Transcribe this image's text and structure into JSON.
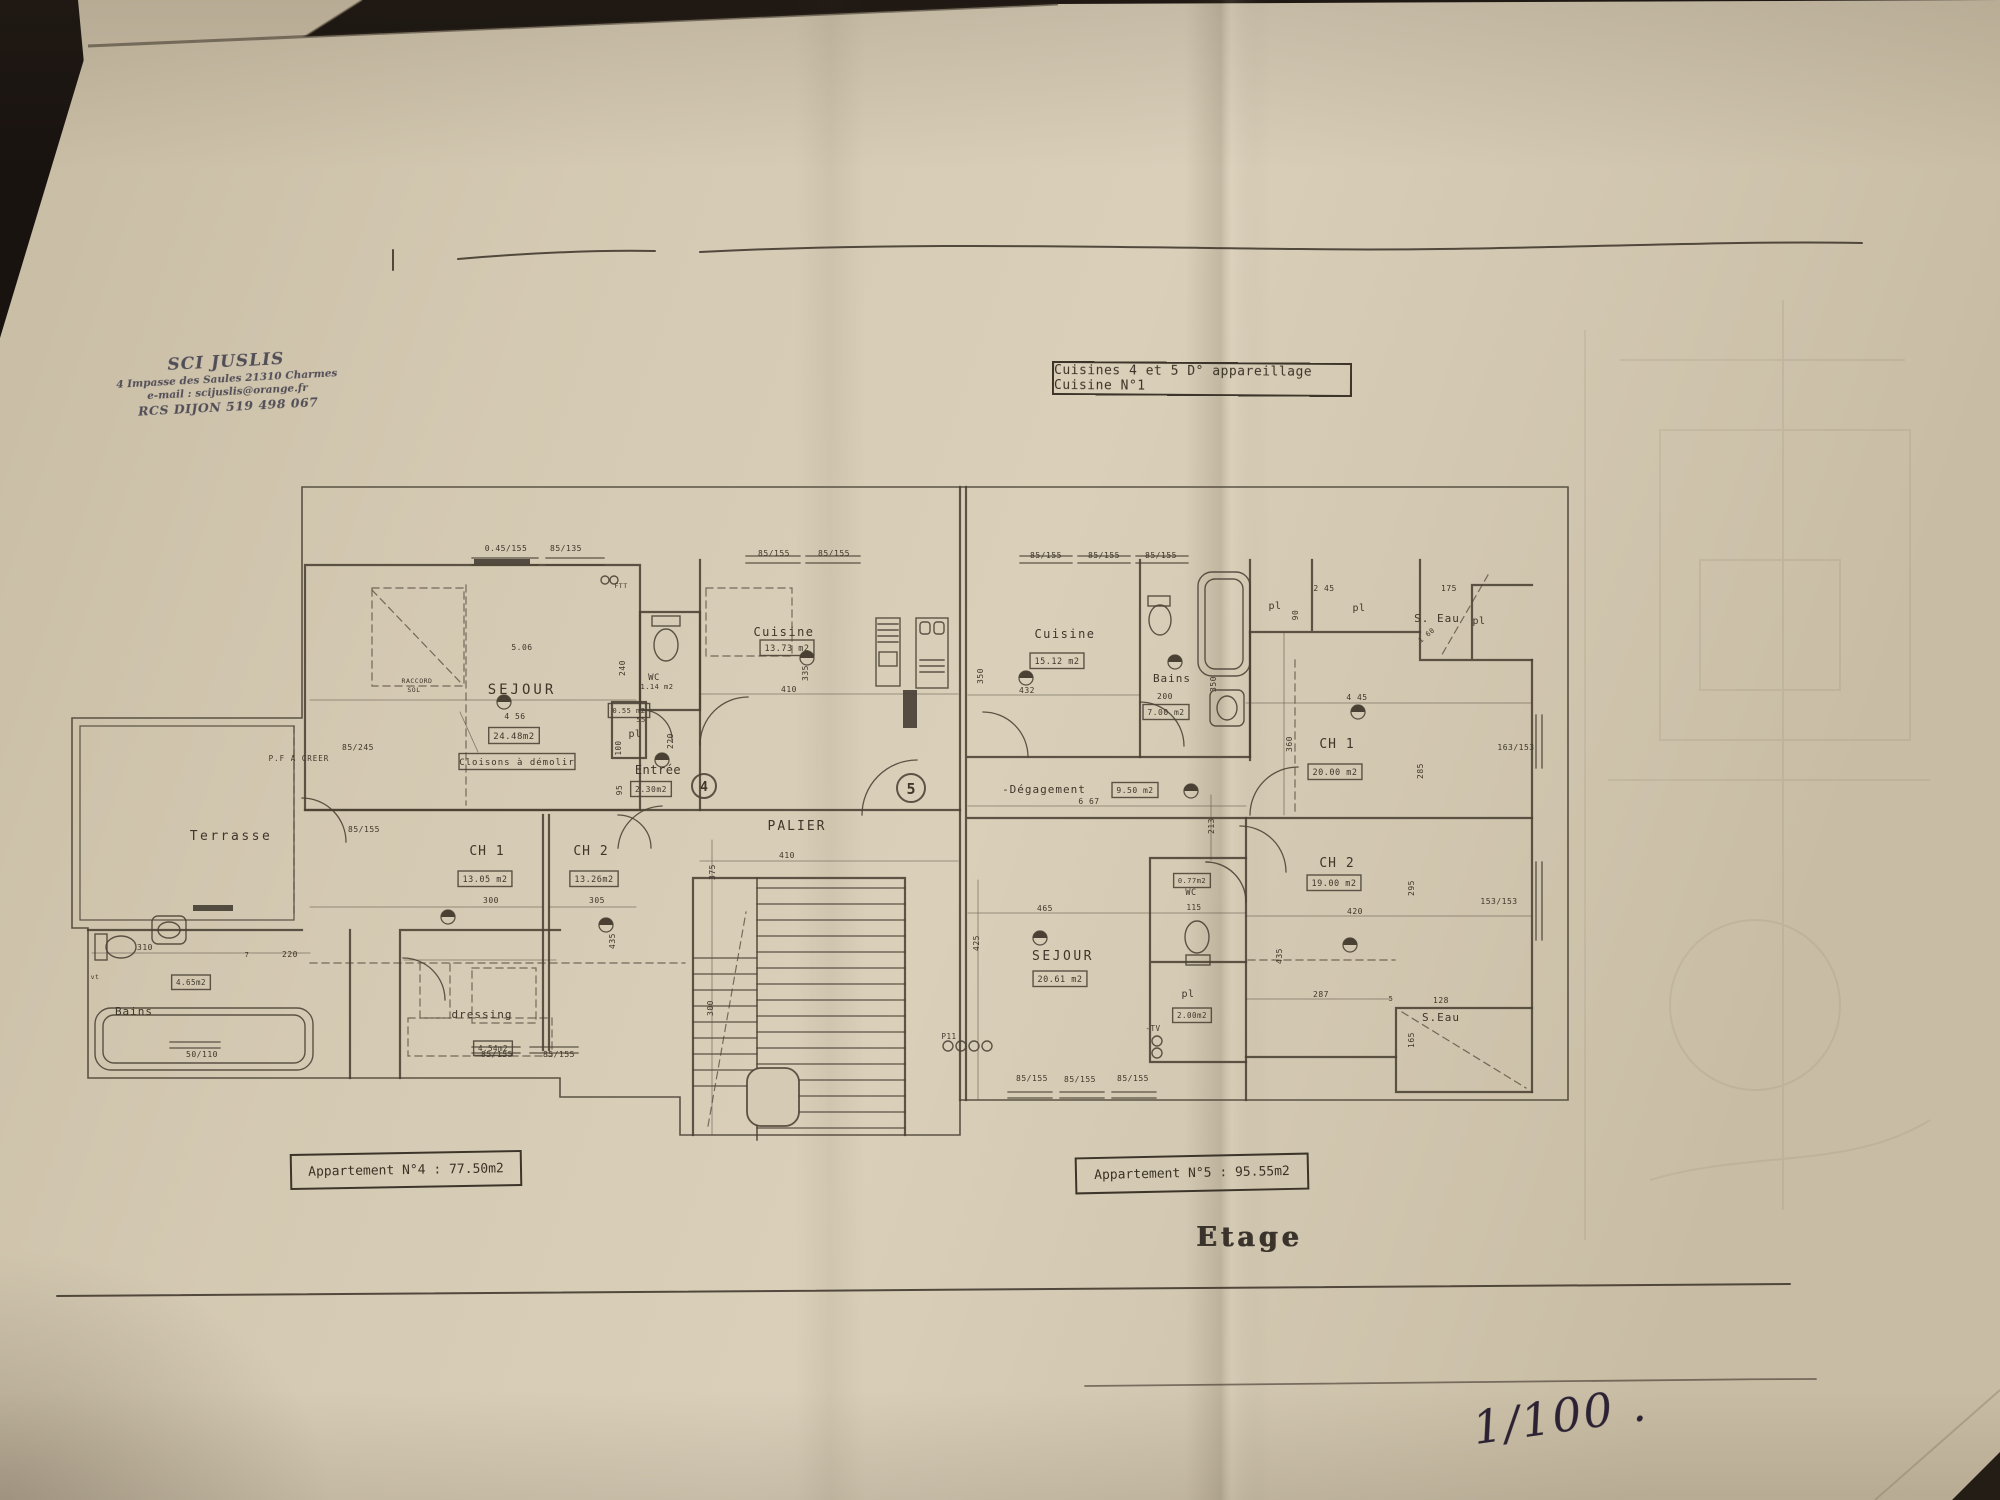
{
  "photo": {
    "background_color": "#191310",
    "paper_color": "#d5c9b2",
    "ink_color": "#4a4134",
    "stamp_ink": "#43414e",
    "handwriting_ink": "#2c2233"
  },
  "stamp": {
    "company": "SCI JUSLIS",
    "address": "4 Impasse des Saules 21310 Charmes",
    "email": "e-mail : scijuslis@orange.fr",
    "rcs": "RCS DIJON 519 498 067"
  },
  "title_box": {
    "text": "Cuisines 4 et 5  D° appareillage  Cuisine N°1"
  },
  "apartment_labels": {
    "apt4": "Appartement N°4  : 77.50m2",
    "apt5": "Appartement N°5 : 95.55m2"
  },
  "floor_label": "Etage",
  "scale_note": "1/100 .",
  "plan": {
    "circled_units": [
      "4",
      "5"
    ],
    "symbols": [
      [
        504,
        702
      ],
      [
        448,
        917
      ],
      [
        606,
        925
      ],
      [
        662,
        760
      ],
      [
        807,
        658
      ],
      [
        1026,
        678
      ],
      [
        1191,
        791
      ],
      [
        1175,
        662
      ],
      [
        1358,
        712
      ],
      [
        1350,
        945
      ],
      [
        1040,
        938
      ]
    ],
    "labels": [
      {
        "t": "Terrasse",
        "x": 231,
        "y": 840,
        "s": 13,
        "ls": 2.5
      },
      {
        "t": "P.F A CREER",
        "x": 299,
        "y": 761,
        "s": 7.5,
        "ls": 1
      },
      {
        "t": "SEJOUR",
        "x": 522,
        "y": 694,
        "s": 14,
        "ls": 3
      },
      {
        "t": "4 56",
        "x": 515,
        "y": 719,
        "s": 8
      },
      {
        "t": "5.06",
        "x": 522,
        "y": 650,
        "s": 8
      },
      {
        "t": "24.48m2",
        "x": 514,
        "y": 739,
        "b": 1,
        "s": 9
      },
      {
        "t": "Cloisons à démolir",
        "x": 517,
        "y": 765,
        "b": 1,
        "s": 9,
        "ls": 1
      },
      {
        "t": "RACCORD",
        "x": 417,
        "y": 683,
        "s": 6.5
      },
      {
        "t": "SOL",
        "x": 414,
        "y": 692,
        "s": 6.5
      },
      {
        "t": "CH 1",
        "x": 487,
        "y": 855,
        "s": 13,
        "ls": 1
      },
      {
        "t": "13.05 m2",
        "x": 485,
        "y": 882,
        "b": 1,
        "s": 8.5
      },
      {
        "t": "300",
        "x": 491,
        "y": 903,
        "s": 8
      },
      {
        "t": "CH 2",
        "x": 591,
        "y": 855,
        "s": 13,
        "ls": 1
      },
      {
        "t": "13.26m2",
        "x": 594,
        "y": 882,
        "b": 1,
        "s": 8.5
      },
      {
        "t": "305",
        "x": 597,
        "y": 903,
        "s": 8
      },
      {
        "t": "Bains",
        "x": 134,
        "y": 1015,
        "s": 11,
        "ls": 1
      },
      {
        "t": "4.65m2",
        "x": 191,
        "y": 985,
        "b": 1,
        "s": 7.5
      },
      {
        "t": "310",
        "x": 145,
        "y": 950,
        "s": 8
      },
      {
        "t": "vt",
        "x": 95,
        "y": 979,
        "s": 6.5
      },
      {
        "t": "dressing",
        "x": 482,
        "y": 1018,
        "s": 11,
        "ls": 1
      },
      {
        "t": "4.54m2",
        "x": 493,
        "y": 1051,
        "b": 1,
        "s": 7.5
      },
      {
        "t": "220",
        "x": 290,
        "y": 957,
        "s": 8
      },
      {
        "t": "7",
        "x": 247,
        "y": 957,
        "s": 7
      },
      {
        "t": "50/110",
        "x": 202,
        "y": 1057,
        "s": 8
      },
      {
        "t": "85/155",
        "x": 497,
        "y": 1057,
        "s": 8
      },
      {
        "t": "85/155",
        "x": 559,
        "y": 1057,
        "s": 8
      },
      {
        "t": "85/245",
        "x": 358,
        "y": 750,
        "s": 8
      },
      {
        "t": "85/155",
        "x": 364,
        "y": 832,
        "s": 8
      },
      {
        "t": "0.45/155",
        "x": 506,
        "y": 551,
        "s": 8
      },
      {
        "t": "85/135",
        "x": 566,
        "y": 551,
        "s": 8
      },
      {
        "t": "85/155",
        "x": 774,
        "y": 556,
        "s": 8
      },
      {
        "t": "85/155",
        "x": 834,
        "y": 556,
        "s": 8
      },
      {
        "t": "FTT",
        "x": 621,
        "y": 588,
        "s": 6.5
      },
      {
        "t": "WC",
        "x": 654,
        "y": 680,
        "s": 9
      },
      {
        "t": "1.14 m2",
        "x": 657,
        "y": 689,
        "s": 7
      },
      {
        "t": "0.55 m2",
        "x": 629,
        "y": 713,
        "b": 1,
        "s": 7
      },
      {
        "t": "pl",
        "x": 635,
        "y": 737,
        "s": 10
      },
      {
        "t": "100",
        "x": 621,
        "y": 748,
        "r": -90,
        "s": 7.5
      },
      {
        "t": "55",
        "x": 641,
        "y": 722,
        "s": 7
      },
      {
        "t": "240",
        "x": 625,
        "y": 668,
        "r": -90,
        "s": 8
      },
      {
        "t": "220",
        "x": 673,
        "y": 741,
        "r": -90,
        "s": 8
      },
      {
        "t": "95",
        "x": 622,
        "y": 790,
        "r": -90,
        "s": 8
      },
      {
        "t": "Entrée",
        "x": 658,
        "y": 774,
        "s": 12
      },
      {
        "t": "2.30m2",
        "x": 651,
        "y": 792,
        "b": 1,
        "s": 8
      },
      {
        "t": "Cuisine",
        "x": 784,
        "y": 636,
        "s": 12,
        "ls": 1.5
      },
      {
        "t": "13.73 m2",
        "x": 787,
        "y": 651,
        "b": 1,
        "s": 8.5
      },
      {
        "t": "410",
        "x": 789,
        "y": 692,
        "s": 8
      },
      {
        "t": "335",
        "x": 808,
        "y": 673,
        "r": -90,
        "s": 8
      },
      {
        "t": "PALIER",
        "x": 797,
        "y": 830,
        "s": 13,
        "ls": 2
      },
      {
        "t": "410",
        "x": 787,
        "y": 858,
        "s": 8
      },
      {
        "t": "375",
        "x": 715,
        "y": 872,
        "r": -90,
        "s": 8
      },
      {
        "t": "300",
        "x": 713,
        "y": 1008,
        "r": -90,
        "s": 8
      },
      {
        "t": "435",
        "x": 615,
        "y": 941,
        "r": -90,
        "s": 8
      },
      {
        "t": "85/155",
        "x": 1046,
        "y": 558,
        "s": 8
      },
      {
        "t": "85/155",
        "x": 1104,
        "y": 558,
        "s": 8
      },
      {
        "t": "85/155",
        "x": 1161,
        "y": 558,
        "s": 8
      },
      {
        "t": "Cuisine",
        "x": 1065,
        "y": 638,
        "s": 12,
        "ls": 1.5
      },
      {
        "t": "15.12 m2",
        "x": 1057,
        "y": 664,
        "b": 1,
        "s": 8.5
      },
      {
        "t": "432",
        "x": 1027,
        "y": 693,
        "s": 8
      },
      {
        "t": "350",
        "x": 983,
        "y": 676,
        "r": -90,
        "s": 8
      },
      {
        "t": "350",
        "x": 1216,
        "y": 684,
        "r": -90,
        "s": 8
      },
      {
        "t": "Bains",
        "x": 1172,
        "y": 682,
        "s": 11,
        "ls": 1
      },
      {
        "t": "200",
        "x": 1165,
        "y": 699,
        "s": 8
      },
      {
        "t": "7.00 m2",
        "x": 1166,
        "y": 715,
        "b": 1,
        "s": 8
      },
      {
        "t": "-Dégagement",
        "x": 1044,
        "y": 793,
        "s": 11,
        "ls": 1
      },
      {
        "t": "6 67",
        "x": 1089,
        "y": 804,
        "s": 8
      },
      {
        "t": "9.50 m2",
        "x": 1135,
        "y": 793,
        "b": 1,
        "s": 8
      },
      {
        "t": "213",
        "x": 1214,
        "y": 826,
        "r": -90,
        "s": 8
      },
      {
        "t": "pl",
        "x": 1275,
        "y": 609,
        "s": 10
      },
      {
        "t": "90",
        "x": 1298,
        "y": 615,
        "r": -90,
        "s": 8
      },
      {
        "t": "2 45",
        "x": 1324,
        "y": 591,
        "s": 8
      },
      {
        "t": "pl",
        "x": 1359,
        "y": 611,
        "s": 10
      },
      {
        "t": "175",
        "x": 1449,
        "y": 591,
        "s": 8
      },
      {
        "t": "S. Eau",
        "x": 1437,
        "y": 622,
        "s": 11,
        "ls": 1
      },
      {
        "t": "pl",
        "x": 1479,
        "y": 624,
        "s": 10
      },
      {
        "t": "1 60",
        "x": 1428,
        "y": 637,
        "r": -40,
        "s": 7
      },
      {
        "t": "CH 1",
        "x": 1337,
        "y": 748,
        "s": 13,
        "ls": 1
      },
      {
        "t": "20.00 m2",
        "x": 1335,
        "y": 775,
        "b": 1,
        "s": 8.5
      },
      {
        "t": "4 45",
        "x": 1357,
        "y": 700,
        "s": 8
      },
      {
        "t": "360",
        "x": 1292,
        "y": 744,
        "r": -90,
        "s": 8
      },
      {
        "t": "285",
        "x": 1423,
        "y": 771,
        "r": -90,
        "s": 8
      },
      {
        "t": "163/153",
        "x": 1516,
        "y": 750,
        "s": 8
      },
      {
        "t": "CH 2",
        "x": 1337,
        "y": 867,
        "s": 13,
        "ls": 1
      },
      {
        "t": "19.00 m2",
        "x": 1334,
        "y": 886,
        "b": 1,
        "s": 8.5
      },
      {
        "t": "420",
        "x": 1355,
        "y": 914,
        "s": 8
      },
      {
        "t": "295",
        "x": 1414,
        "y": 888,
        "r": -90,
        "s": 8
      },
      {
        "t": "435",
        "x": 1282,
        "y": 956,
        "r": -90,
        "s": 8
      },
      {
        "t": "287",
        "x": 1321,
        "y": 997,
        "s": 8
      },
      {
        "t": "5",
        "x": 1391,
        "y": 1001,
        "s": 7
      },
      {
        "t": "153/153",
        "x": 1499,
        "y": 904,
        "s": 8
      },
      {
        "t": "S.Eau",
        "x": 1441,
        "y": 1021,
        "s": 11,
        "ls": 1
      },
      {
        "t": "128",
        "x": 1441,
        "y": 1003,
        "s": 8
      },
      {
        "t": "165",
        "x": 1414,
        "y": 1040,
        "r": -90,
        "s": 8
      },
      {
        "t": "WC",
        "x": 1191,
        "y": 895,
        "s": 8.5
      },
      {
        "t": "0.77m2",
        "x": 1192,
        "y": 883,
        "b": 1,
        "s": 7
      },
      {
        "t": "115",
        "x": 1194,
        "y": 910,
        "s": 7.5
      },
      {
        "t": "pl",
        "x": 1188,
        "y": 997,
        "s": 10
      },
      {
        "t": "2.00m2",
        "x": 1192,
        "y": 1018,
        "b": 1,
        "s": 7.5
      },
      {
        "t": "-TV",
        "x": 1153,
        "y": 1031,
        "s": 7.5
      },
      {
        "t": "SEJOUR",
        "x": 1063,
        "y": 960,
        "s": 13,
        "ls": 2.5
      },
      {
        "t": "20.61 m2",
        "x": 1060,
        "y": 982,
        "b": 1,
        "s": 8.5
      },
      {
        "t": "465",
        "x": 1045,
        "y": 911,
        "s": 8
      },
      {
        "t": "425",
        "x": 979,
        "y": 943,
        "r": -90,
        "s": 8
      },
      {
        "t": "P11",
        "x": 949,
        "y": 1039,
        "s": 7.5
      },
      {
        "t": "85/155",
        "x": 1032,
        "y": 1081,
        "s": 8
      },
      {
        "t": "85/155",
        "x": 1080,
        "y": 1082,
        "s": 8
      },
      {
        "t": "85/155",
        "x": 1133,
        "y": 1081,
        "s": 8
      }
    ]
  }
}
